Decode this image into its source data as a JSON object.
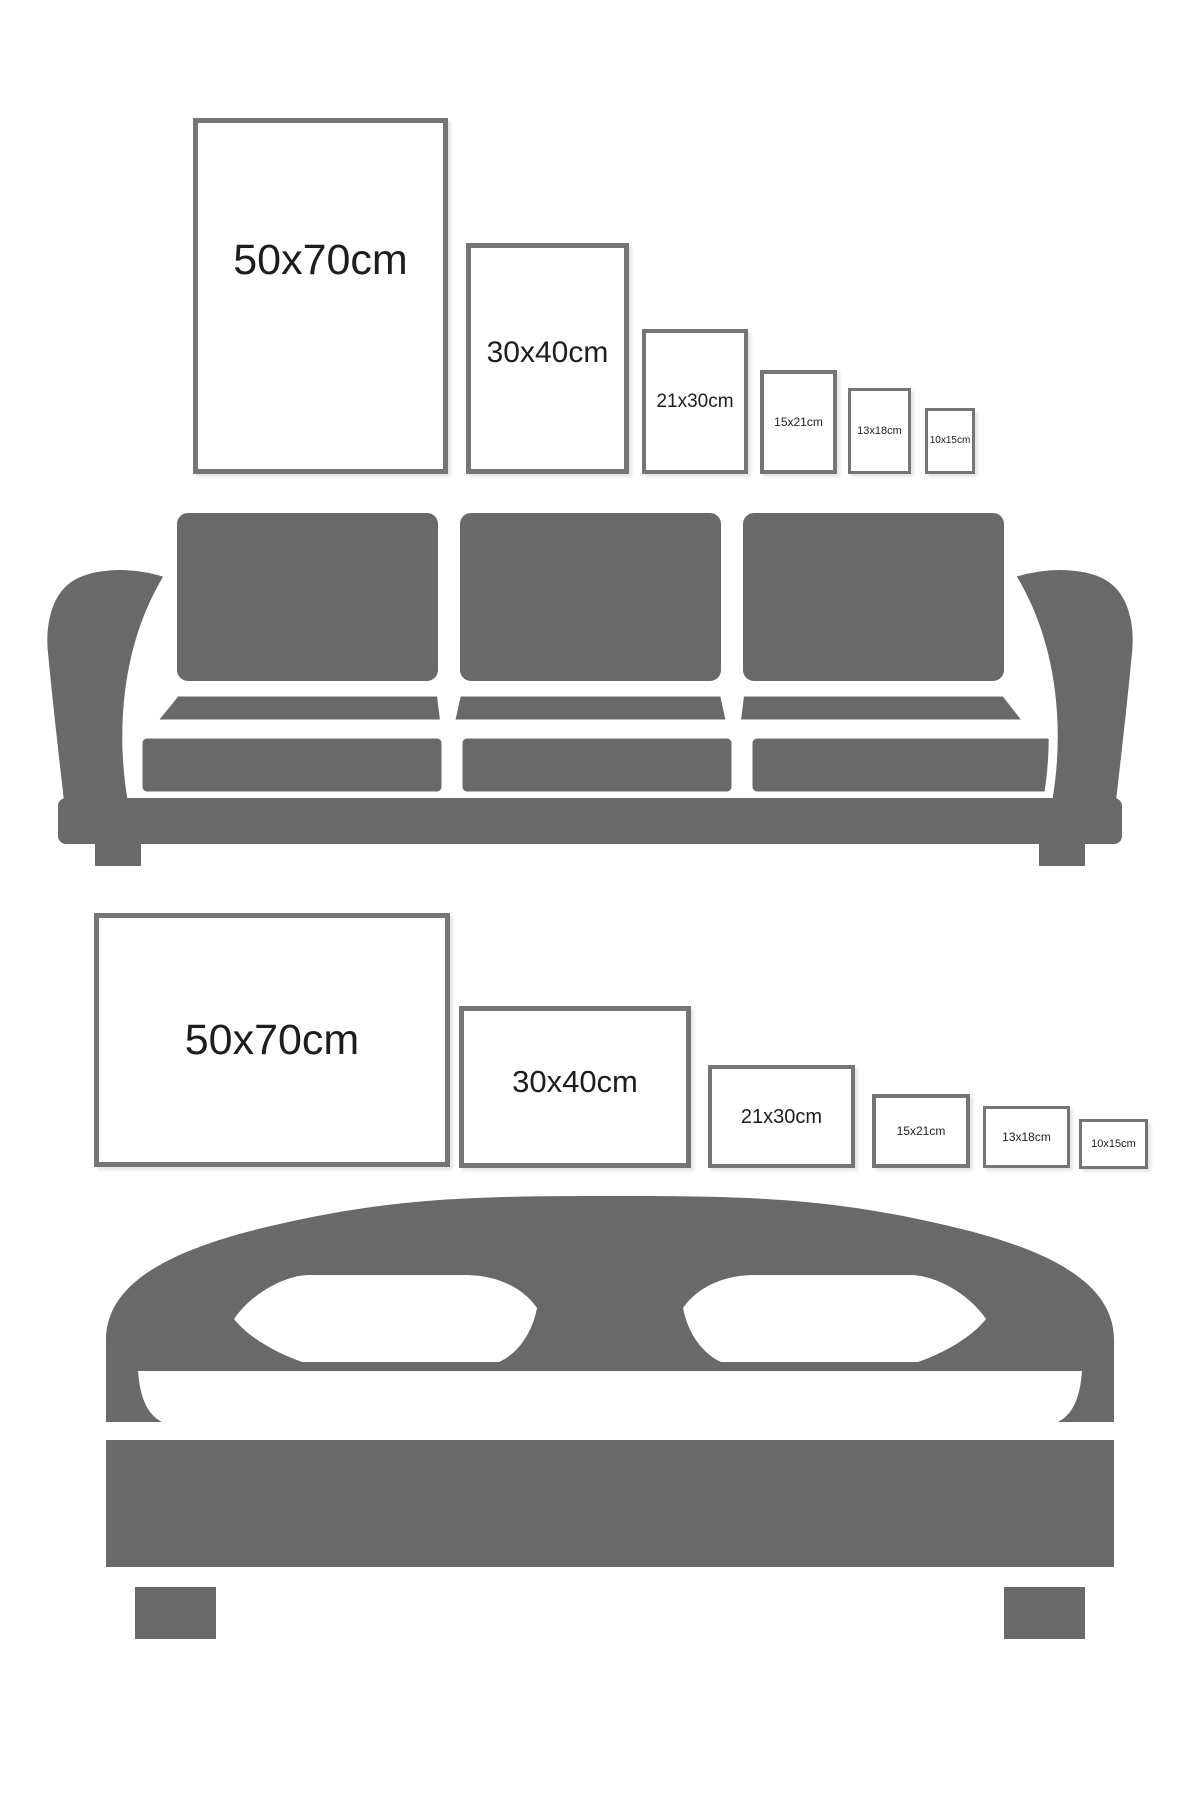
{
  "theme": {
    "background": "#ffffff",
    "furniture_color": "#696969",
    "frame_border_color": "#757575",
    "label_color": "#1d1d1d"
  },
  "sofa_section": {
    "furniture": "sofa",
    "orientation": "portrait",
    "frames": [
      {
        "label": "50x70cm"
      },
      {
        "label": "30x40cm"
      },
      {
        "label": "21x30cm"
      },
      {
        "label": "15x21cm"
      },
      {
        "label": "13x18cm"
      },
      {
        "label": "10x15cm"
      }
    ]
  },
  "bed_section": {
    "furniture": "bed",
    "orientation": "landscape",
    "frames": [
      {
        "label": "50x70cm"
      },
      {
        "label": "30x40cm"
      },
      {
        "label": "21x30cm"
      },
      {
        "label": "15x21cm"
      },
      {
        "label": "13x18cm"
      },
      {
        "label": "10x15cm"
      }
    ]
  }
}
